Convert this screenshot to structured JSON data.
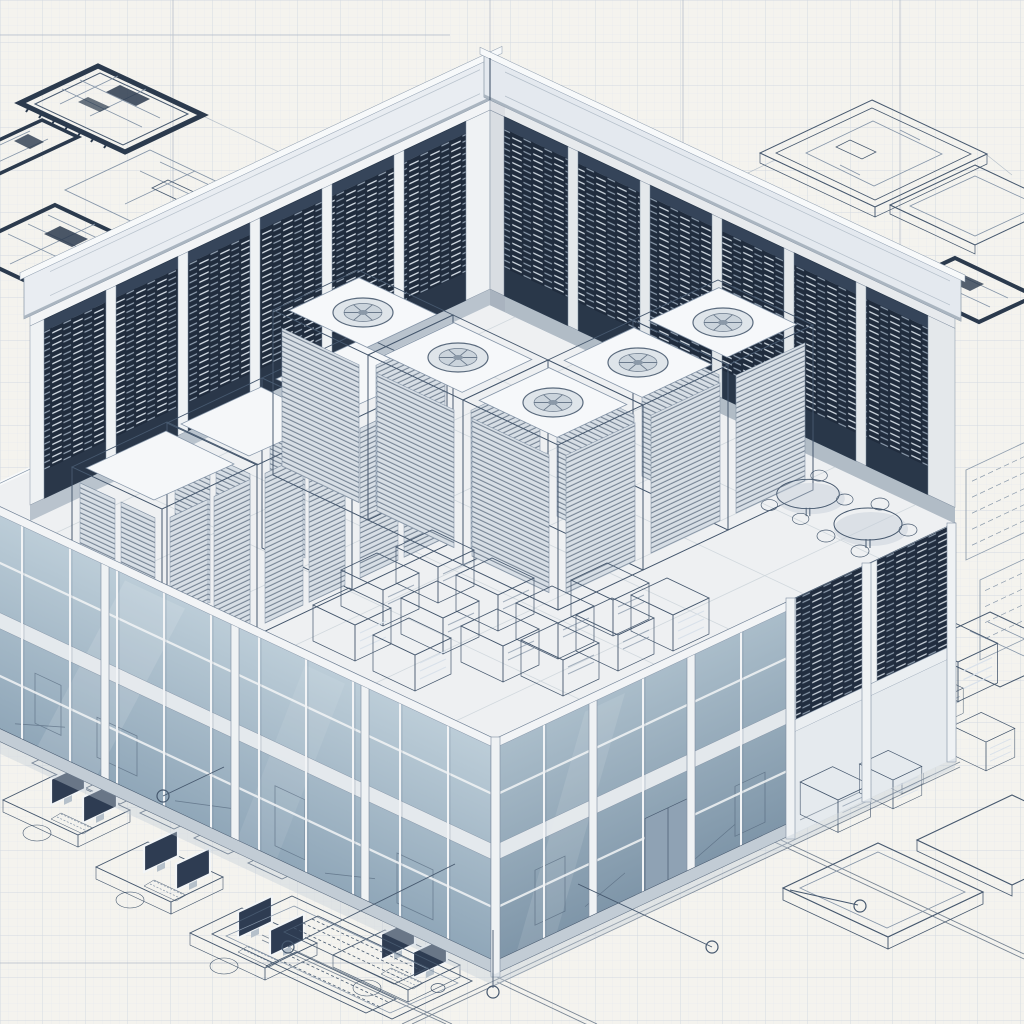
{
  "scene": {
    "style": "isometric architectural blueprint sketch",
    "subject": "data center building cutaway on graph paper",
    "components": {
      "server_rack_wall_bays_left": 6,
      "server_rack_wall_bays_right": 6,
      "cooling_fan_roof_units": 5,
      "slatted_rack_towers": 3,
      "floor_equipment_cabinets": 12,
      "office_glass_floors": 2,
      "break_tables": 2,
      "workstation_desks": 4,
      "floor_plan_sketches": 4,
      "equipment_tray_sketches": 3,
      "foundation_pad_sketches": 2,
      "dimension_markers": 5
    }
  },
  "palette": {
    "paper": "#f4f3ee",
    "gridFine": "#e4e8ed",
    "gridMed": "#d3dae1",
    "gridAccent": "#a9b5c2",
    "ink": "#46586e",
    "inkSoft": "#8494a7",
    "inkDark": "#2b3a4d",
    "rackDark": "#202c3d",
    "rackDash": "#d9e1ea",
    "rackDash2": "#a2b2c2",
    "steelLight": "#eff2f4",
    "steelMid": "#d5dce3",
    "steelShade": "#b5c0ca",
    "wallBg": "#dce2e8",
    "glassTopL": "#bccdd8",
    "glassBotL": "#8fa6b8",
    "glassTopR": "#aabdca",
    "glassBotR": "#7e95a8",
    "floorFill": "#eef0f2",
    "interior": "#e0e7ed",
    "screen": "#2e3c52",
    "white": "#f8fafb",
    "shadow": "#c3cdd6",
    "band": "#f2f4f6"
  }
}
